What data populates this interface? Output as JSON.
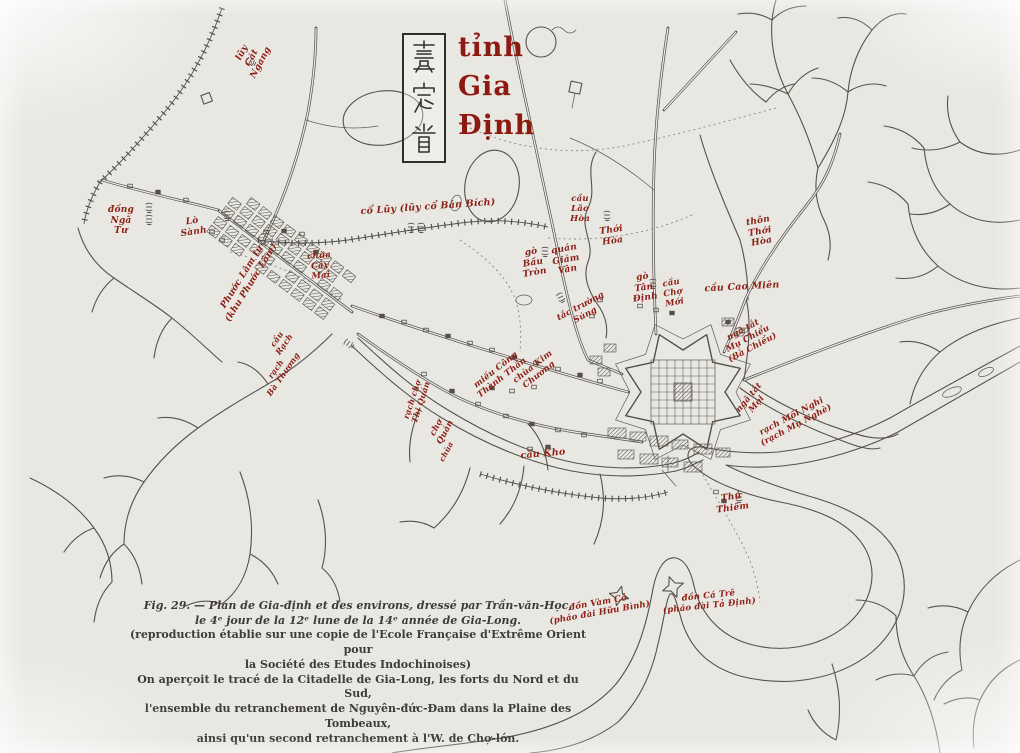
{
  "figure": {
    "type": "historical-map-scan",
    "figure_number": "Fig. 29",
    "seal": {
      "characters": "嘉定省",
      "reading": "tỉnh Gia Định"
    },
    "title": {
      "lines": [
        "tỉnh",
        "Gia",
        "Định"
      ]
    },
    "caption": {
      "lines": [
        "Fig. 29. — Plan de Gia-định et des environs, dressé par Trần-văn-Học,",
        "le 4ᵉ jour de la 12ᵉ lune de la 14ᵉ année de Gia-Long.",
        "(reproduction établie sur une copie de l'Ecole Française d'Extrême Orient pour",
        "la Société des Etudes Indochinoises)",
        "On aperçoit le tracé de la Citadelle de Gia-Long, les forts du Nord et du Sud,",
        "l'ensemble du retranchement de Nguyên-đức-Đam dans la Plaine des Tombeaux,",
        "ainsi qu'un second retranchement à l'W. de Chợ-lớn."
      ]
    },
    "colors": {
      "paper": "#e9e7e2",
      "ink": "#56524b",
      "label_red": "#8e2117",
      "title_red": "#8c1a10",
      "caption_ink": "#3f3c36"
    },
    "labels": [
      {
        "id": "luy-cat-ngang",
        "lines": [
          "lũy",
          "Cát",
          "Ngang"
        ],
        "x": 252,
        "y": 58,
        "rot": -62,
        "size": 9
      },
      {
        "id": "dong-nga-tu",
        "lines": [
          "đồng",
          "Ngã",
          "Tư"
        ],
        "x": 121,
        "y": 221,
        "rot": 0,
        "size": 9
      },
      {
        "id": "lo-sanh",
        "lines": [
          "Lò",
          "Sành"
        ],
        "x": 193,
        "y": 227,
        "rot": -8,
        "size": 9
      },
      {
        "id": "phuoc-lam",
        "lines": [
          "Phước Lâm tự",
          "(khu Phước Lâm)"
        ],
        "x": 247,
        "y": 280,
        "rot": -58,
        "size": 9
      },
      {
        "id": "chua-cay-mai",
        "lines": [
          "chùa",
          "Cây",
          "Mai"
        ],
        "x": 320,
        "y": 266,
        "rot": -5,
        "size": 8.5
      },
      {
        "id": "co-luy-ban-bich",
        "lines": [
          "cổ Lũy (lũy cổ Bán Bích)"
        ],
        "x": 428,
        "y": 207,
        "rot": -4,
        "size": 9.5
      },
      {
        "id": "go-bau-tron",
        "lines": [
          "gò",
          "Bầu",
          "Tròn"
        ],
        "x": 533,
        "y": 263,
        "rot": -10,
        "size": 9
      },
      {
        "id": "quan-giam-van",
        "lines": [
          "quán",
          "Giám",
          "Vân"
        ],
        "x": 566,
        "y": 260,
        "rot": -10,
        "size": 9
      },
      {
        "id": "cau-lao-hoa",
        "lines": [
          "cầu",
          "Lão",
          "Hòa"
        ],
        "x": 580,
        "y": 209,
        "rot": 0,
        "size": 8.5
      },
      {
        "id": "thoi-hoa",
        "lines": [
          "Thới",
          "Hòa"
        ],
        "x": 612,
        "y": 236,
        "rot": -8,
        "size": 9
      },
      {
        "id": "thon-thoi-hoa",
        "lines": [
          "thôn",
          "Thới",
          "Hòa"
        ],
        "x": 760,
        "y": 232,
        "rot": -10,
        "size": 9
      },
      {
        "id": "cau-cao-mien",
        "lines": [
          "cầu Cao Miên"
        ],
        "x": 742,
        "y": 287,
        "rot": -3,
        "size": 9.5
      },
      {
        "id": "go-tan-dinh",
        "lines": [
          "gò",
          "Tân",
          "Định"
        ],
        "x": 644,
        "y": 288,
        "rot": -8,
        "size": 9
      },
      {
        "id": "cau-cho-moi",
        "lines": [
          "cầu",
          "Chợ",
          "Mới"
        ],
        "x": 673,
        "y": 293,
        "rot": -10,
        "size": 8.5
      },
      {
        "id": "tac-truong-sung",
        "lines": [
          "tắc trường",
          "Súng"
        ],
        "x": 583,
        "y": 311,
        "rot": -28,
        "size": 8.5
      },
      {
        "id": "mieu-cong-thanh-than",
        "lines": [
          "miếu Công",
          "Thành Thần"
        ],
        "x": 499,
        "y": 374,
        "rot": -38,
        "size": 8.5
      },
      {
        "id": "chua-kim-chuong",
        "lines": [
          "chùa Kim",
          "Chương"
        ],
        "x": 536,
        "y": 371,
        "rot": -38,
        "size": 8.5
      },
      {
        "id": "rach-cho-quan",
        "lines": [
          "rạch chợ",
          "Thị Quán"
        ],
        "x": 417,
        "y": 401,
        "rot": -72,
        "size": 8
      },
      {
        "id": "cho-quan",
        "lines": [
          "chợ",
          "Quán"
        ],
        "x": 441,
        "y": 430,
        "rot": -62,
        "size": 8.5
      },
      {
        "id": "chua-nho",
        "lines": [
          "chùa"
        ],
        "x": 447,
        "y": 452,
        "rot": -62,
        "size": 7.5
      },
      {
        "id": "cau-rach",
        "lines": [
          "cầu",
          "Rạch"
        ],
        "x": 281,
        "y": 342,
        "rot": -55,
        "size": 8
      },
      {
        "id": "rach-ba-thuong",
        "lines": [
          "rạch",
          "Bà Thương"
        ],
        "x": 280,
        "y": 372,
        "rot": -55,
        "size": 8
      },
      {
        "id": "cau-kho",
        "lines": [
          "cầu Kho"
        ],
        "x": 543,
        "y": 454,
        "rot": -5,
        "size": 9.5
      },
      {
        "id": "nga-tat-mu-chieu",
        "lines": [
          "ngã tắt",
          "Mụ Chiểu",
          "(Bà Chiểu)"
        ],
        "x": 748,
        "y": 339,
        "rot": -28,
        "size": 8.5
      },
      {
        "id": "nga-tat-moi",
        "lines": [
          "ngã tắt",
          "Mọi"
        ],
        "x": 753,
        "y": 401,
        "rot": -50,
        "size": 8.5
      },
      {
        "id": "rach-moi-nghi",
        "lines": [
          "rạch Mồi Nghi",
          "(rạch Mụ Nghè)"
        ],
        "x": 794,
        "y": 421,
        "rot": -28,
        "size": 8.5
      },
      {
        "id": "thu-thiem",
        "lines": [
          "Thủ",
          "Thiêm"
        ],
        "x": 732,
        "y": 503,
        "rot": -8,
        "size": 9
      },
      {
        "id": "don-vam-co",
        "lines": [
          "đồn Vàm Cỏ",
          "(pháo đài Hữu Bình)"
        ],
        "x": 599,
        "y": 608,
        "rot": -10,
        "size": 8.5
      },
      {
        "id": "don-ca-tre",
        "lines": [
          "đồn Cá Trê",
          "(pháo đài Tả Định)"
        ],
        "x": 709,
        "y": 601,
        "rot": -6,
        "size": 8.5
      }
    ]
  }
}
